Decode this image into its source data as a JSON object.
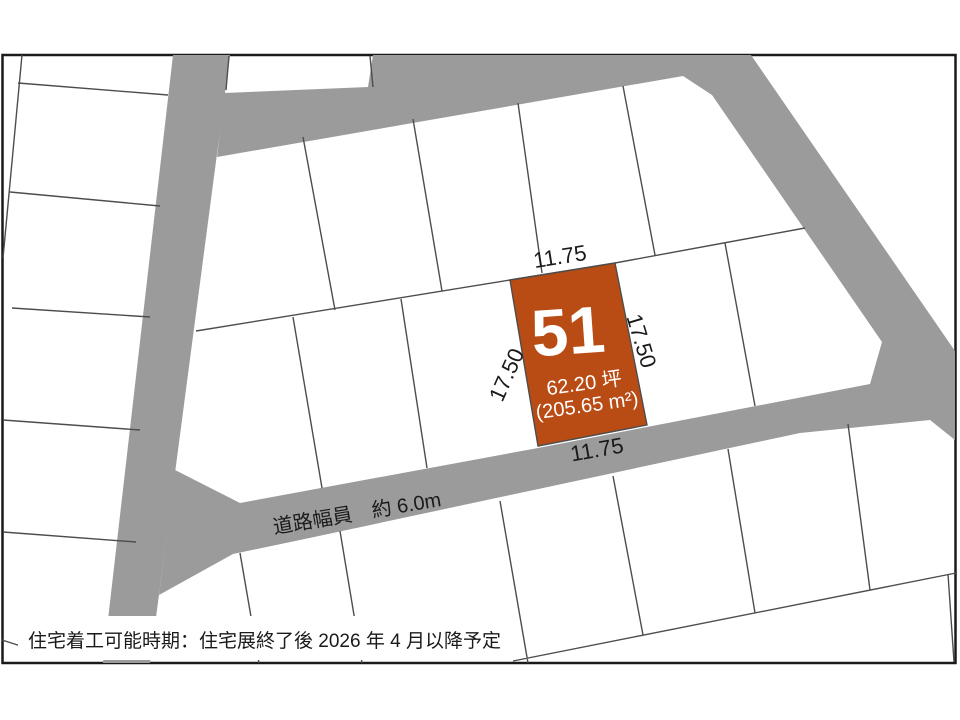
{
  "plan": {
    "lot": {
      "number": "51",
      "area_tsubo": "62.20 坪",
      "area_m2": "(205.65 m²)",
      "dim_top": "11.75",
      "dim_bottom": "11.75",
      "dim_left": "17.50",
      "dim_right": "17.50",
      "fill": "#b94b14"
    },
    "road": {
      "label": "道路幅員　約 6.0m",
      "color": "#9b9b9b"
    },
    "note": "住宅着工可能時期：住宅展終了後 2026 年 4 月以降予定",
    "frame_color": "#1a1a1a",
    "line_color": "#4d4d4d"
  }
}
